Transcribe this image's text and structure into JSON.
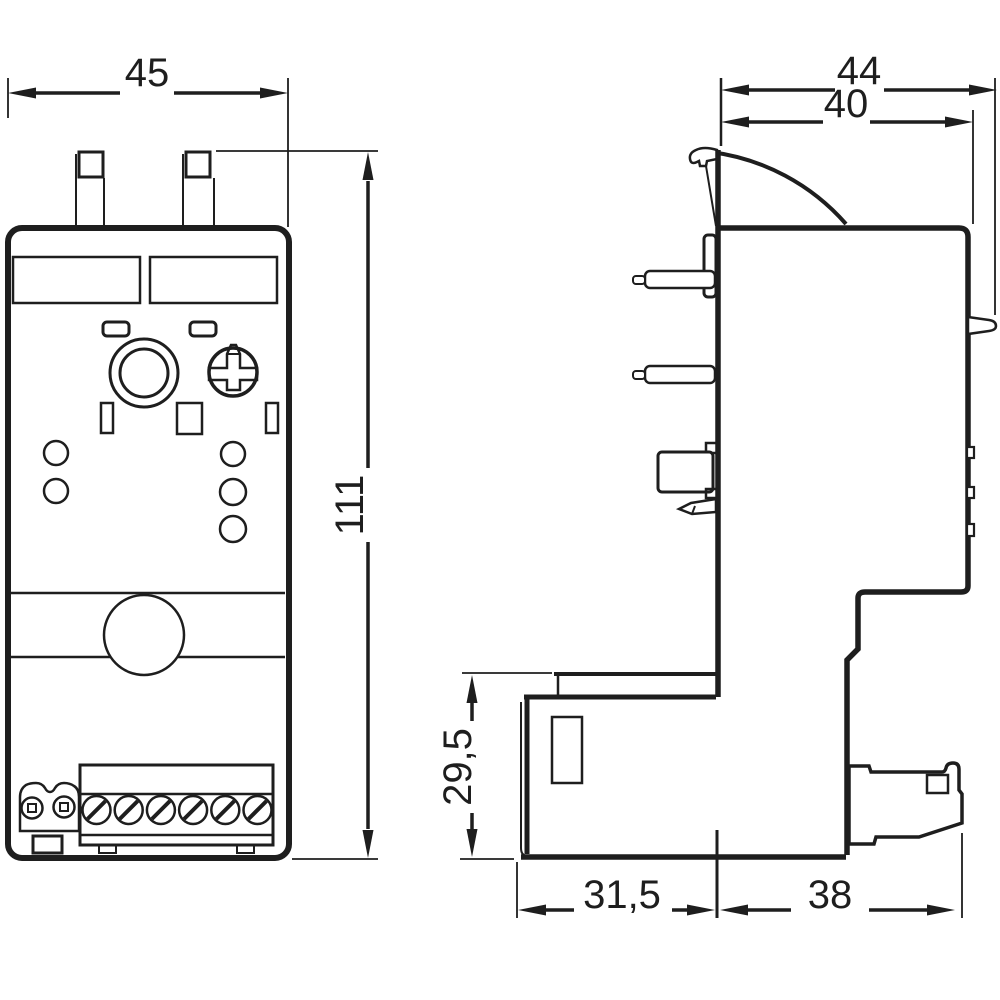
{
  "drawing": {
    "type": "technical dimension drawing, front view and side view of overload relay",
    "colors": {
      "ink": "#1e1e1e",
      "paper": "#ffffff"
    },
    "dims": {
      "front_width": "45",
      "front_height": "111",
      "side_depth_total": "44",
      "side_depth_body": "40",
      "side_lower_height": "29,5",
      "side_lower_depth": "31,5",
      "side_rail_depth": "38"
    }
  }
}
